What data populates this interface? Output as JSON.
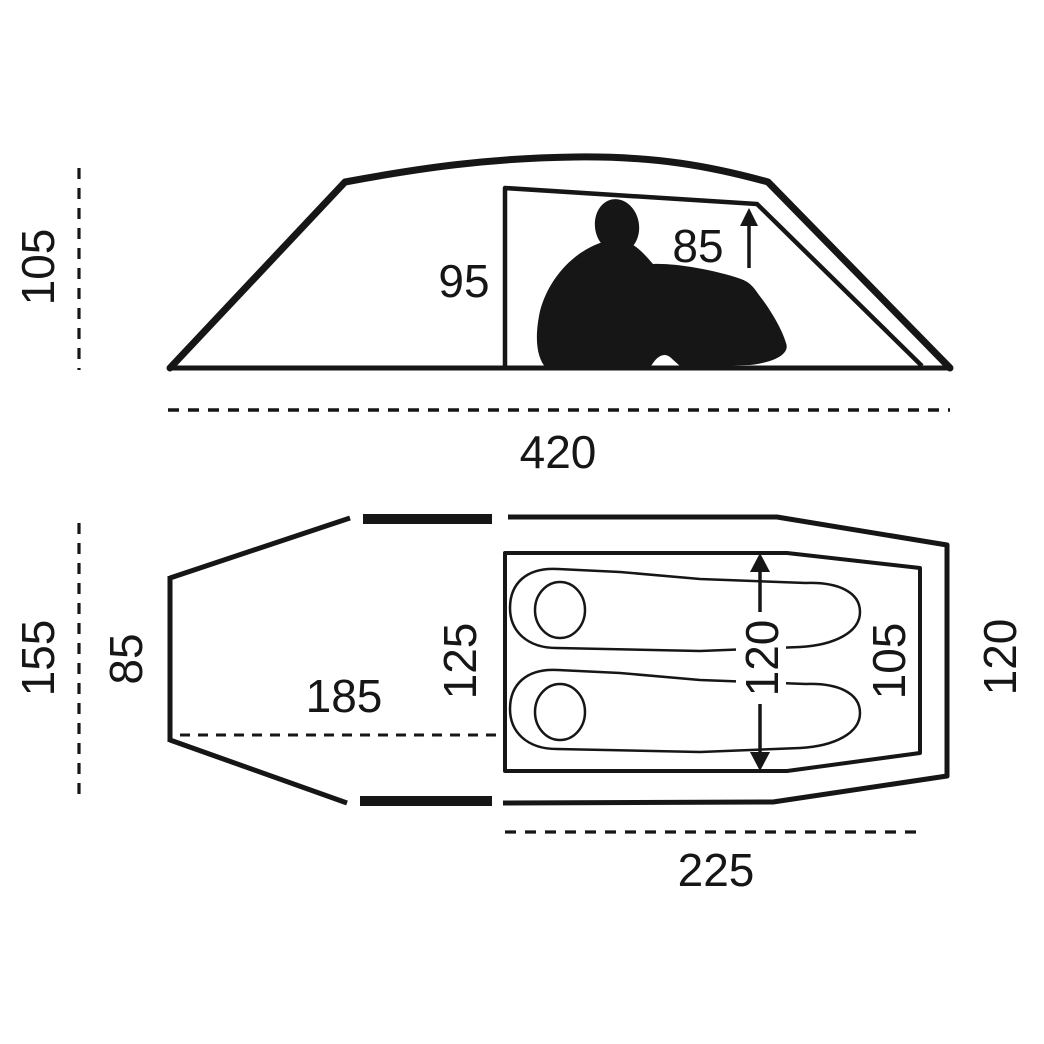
{
  "side_view": {
    "overall_height": "105",
    "inner_height_front": "95",
    "inner_height_rear": "85",
    "overall_length": "420"
  },
  "top_view": {
    "overall_width": "155",
    "vestibule_width": "85",
    "vestibule_length": "185",
    "inner_width_head": "125",
    "inner_width_arrow": "120",
    "inner_width_foot": "105",
    "outer_width_foot": "120",
    "inner_length": "225"
  },
  "colors": {
    "line": "#161616",
    "background": "#ffffff"
  }
}
